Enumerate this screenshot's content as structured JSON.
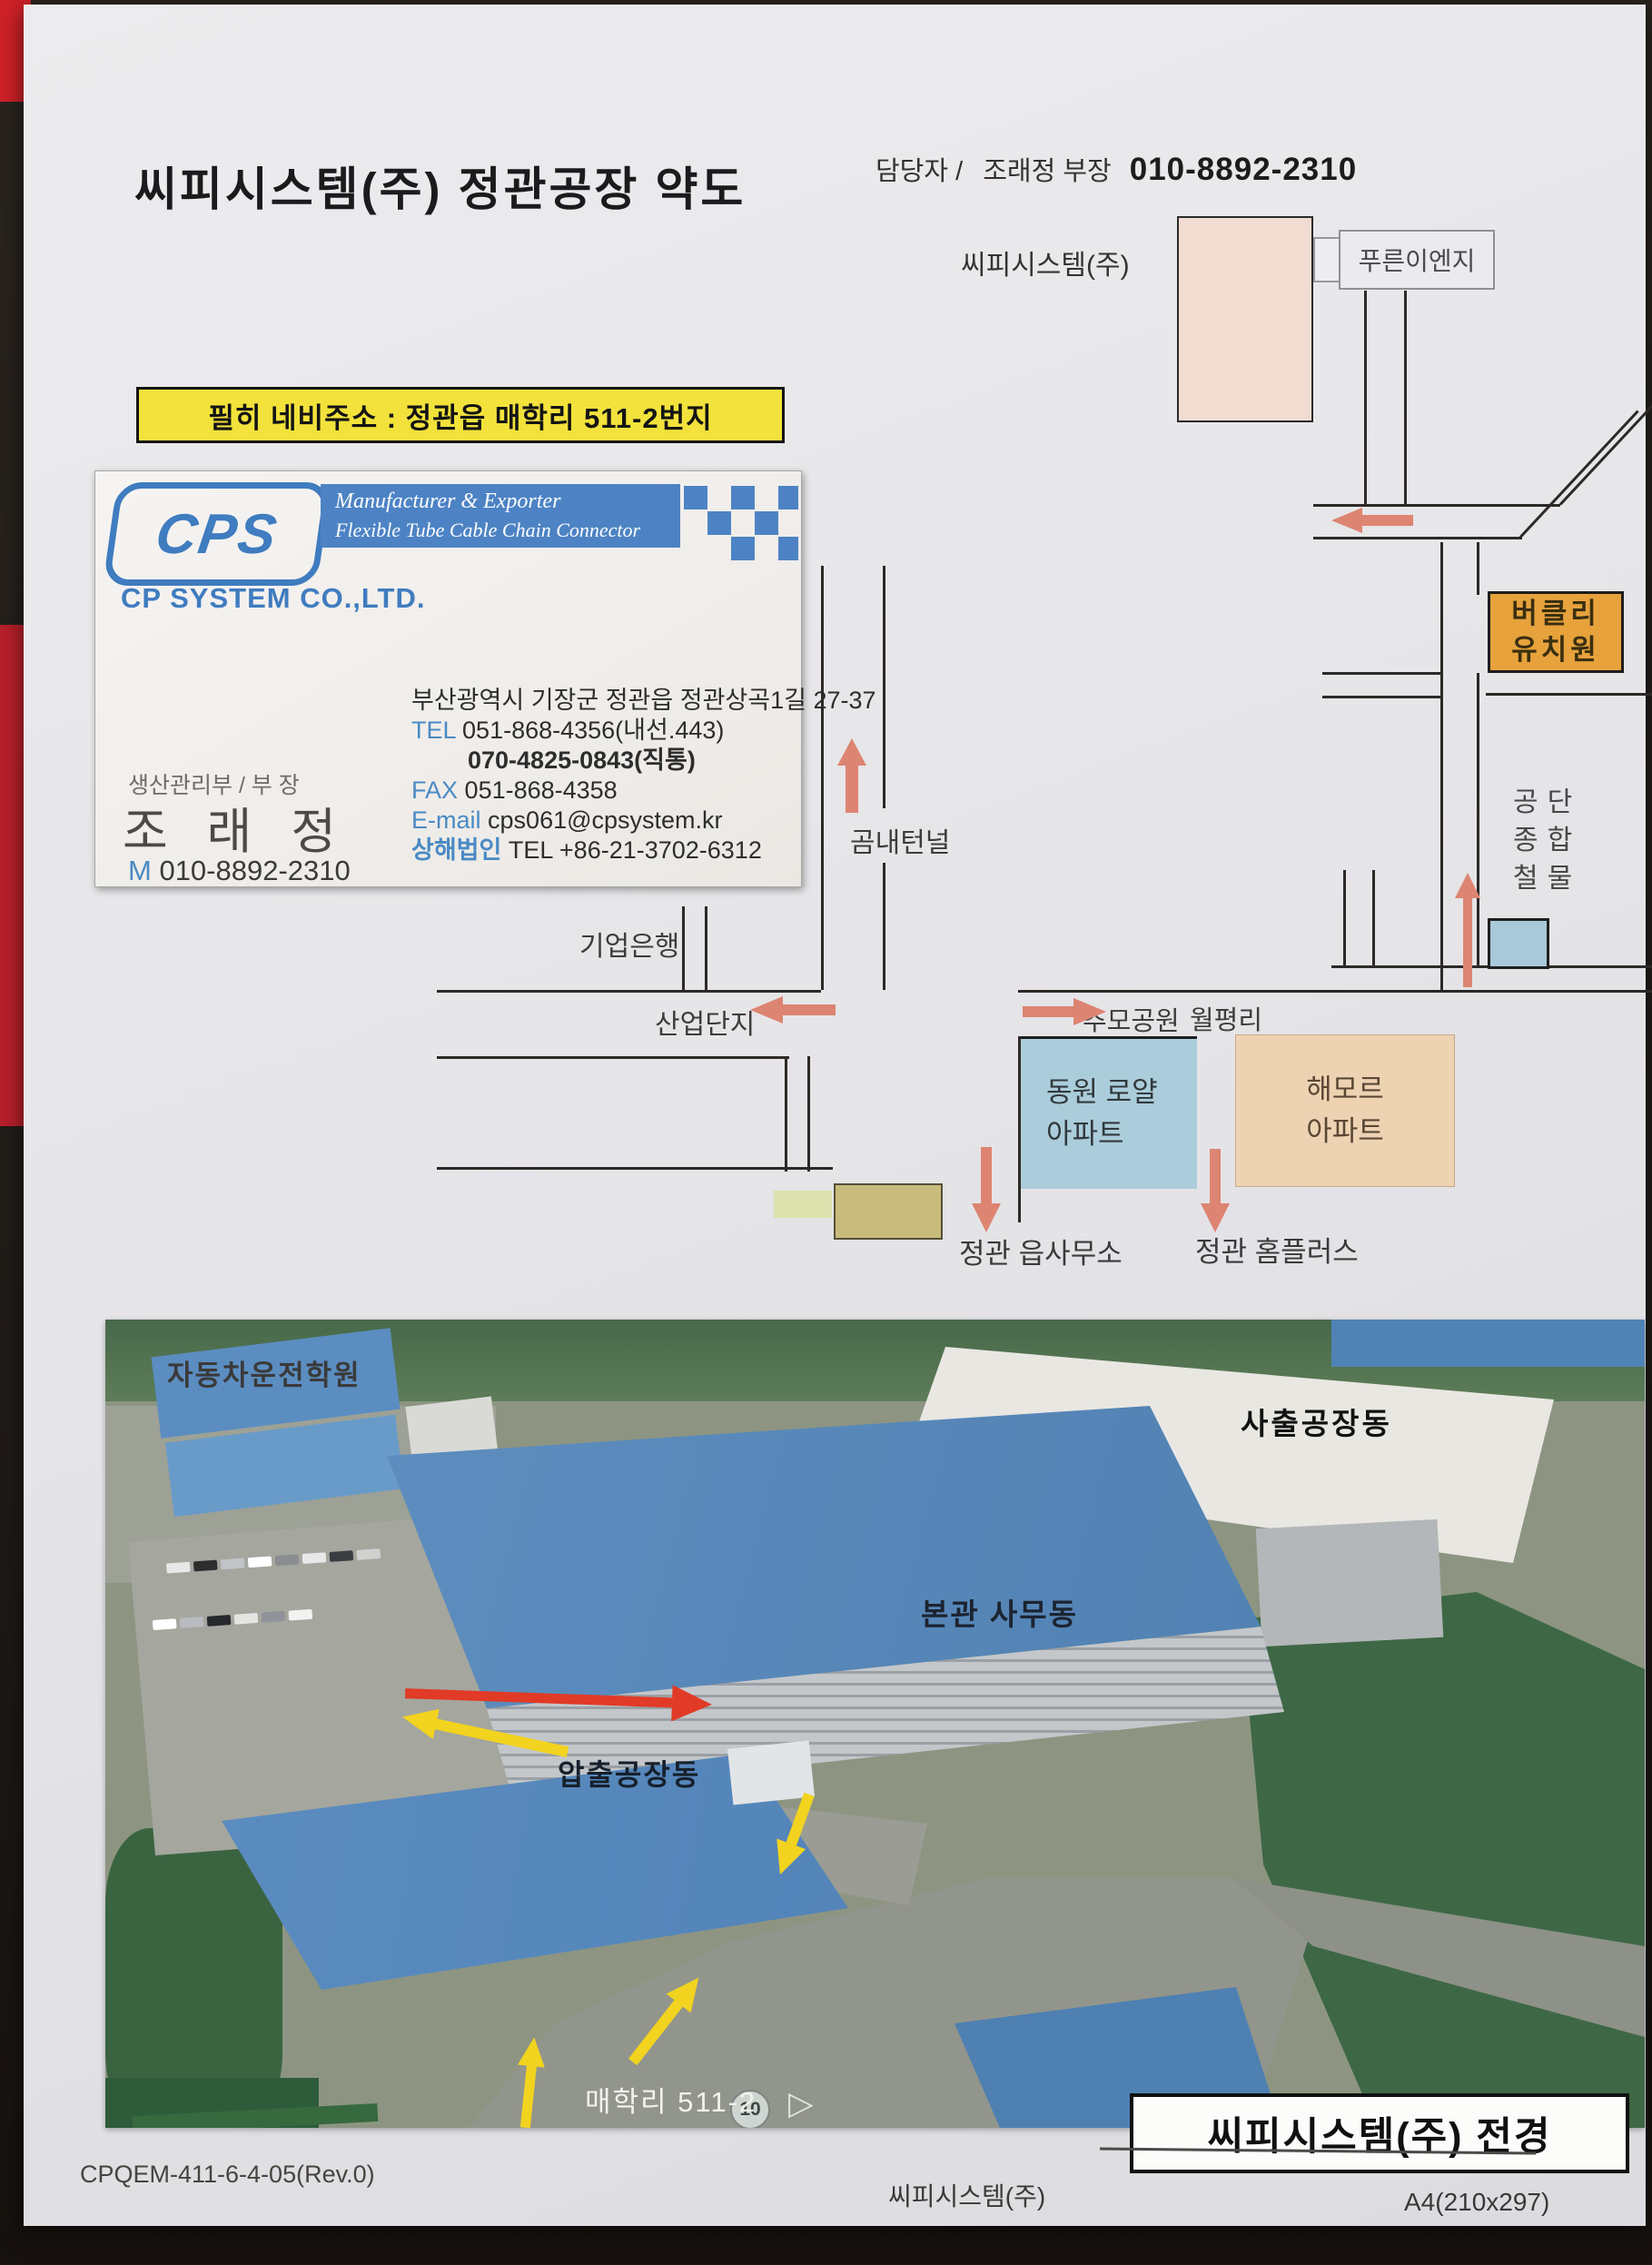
{
  "page": {
    "title": "씨피시스템(주) 정관공장 약도",
    "contact_label": "담당자 /",
    "contact_name": "조래정 부장",
    "contact_phone": "010-8892-2310",
    "nav_note": "필히 네비주소 : 정관읍 매학리 511-2번지"
  },
  "business_card": {
    "logo_text": "CPS",
    "tagline1": "Manufacturer & Exporter",
    "tagline2": "Flexible Tube  Cable Chain   Connector",
    "company": "CP SYSTEM CO.,LTD.",
    "dept_title": "생산관리부 / 부 장",
    "person_name": "조 래 정",
    "mobile_label": "M",
    "mobile": "010-8892-2310",
    "address": "부산광역시 기장군 정관읍 정관상곡1길 27-37",
    "tel_label": "TEL",
    "tel": "051-868-4356(내선.443)",
    "tel2": "070-4825-0843(직통)",
    "fax_label": "FAX",
    "fax": "051-868-4358",
    "email_label": "E-mail",
    "email": "cps061@cpsystem.kr",
    "shanghai_label": "상해법인",
    "shanghai_tel": "TEL +86-21-3702-6312"
  },
  "map": {
    "factory_label": "씨피시스템(주)",
    "pureun": "푸른이엔지",
    "berkeley_line1": "버클리",
    "berkeley_line2": "유치원",
    "gongdan_line1": "공단",
    "gongdan_line2": "종합",
    "gongdan_line3": "철물",
    "gomnae_tunnel": "곰내턴널",
    "bank": "기업은행",
    "industrial": "산업단지",
    "memorial_park": "추모공원",
    "wolpyeongri": "월평리",
    "dongwon_line1": "동원 로얄",
    "dongwon_line2": "아파트",
    "haemoreu_line1": "해모르",
    "haemoreu_line2": "아파트",
    "township_office": "정관 읍사무소",
    "homeplus": "정관 홈플러스"
  },
  "photo": {
    "driving_school": "자동차운전학원",
    "injection_plant": "사출공장동",
    "main_office": "본관 사무동",
    "extrusion_plant": "압출공장동",
    "road_address": "매학리  511-2",
    "speed_sign": "10",
    "caption": "씨피시스템(주) 전경"
  },
  "footer": {
    "doc_no": "CPQEM-411-6-4-05(Rev.0)",
    "center": "씨피시스템(주)",
    "right": "A4(210x297)"
  },
  "colors": {
    "paper": "#e8e7e9",
    "highlight_yellow": "#f2e23b",
    "card_blue": "#4d83c4",
    "map_arrow_salmon": "#dd8472",
    "factory_box_pink": "#f1dcd2",
    "kindergarten_orange": "#e7a23c",
    "apartment_blue": "#abcddb",
    "apartment_peach": "#eed3b3",
    "hardware_blue": "#a9c8da",
    "photo_red_arrow": "#e13a26",
    "photo_yellow_arrow": "#f2d31f"
  }
}
